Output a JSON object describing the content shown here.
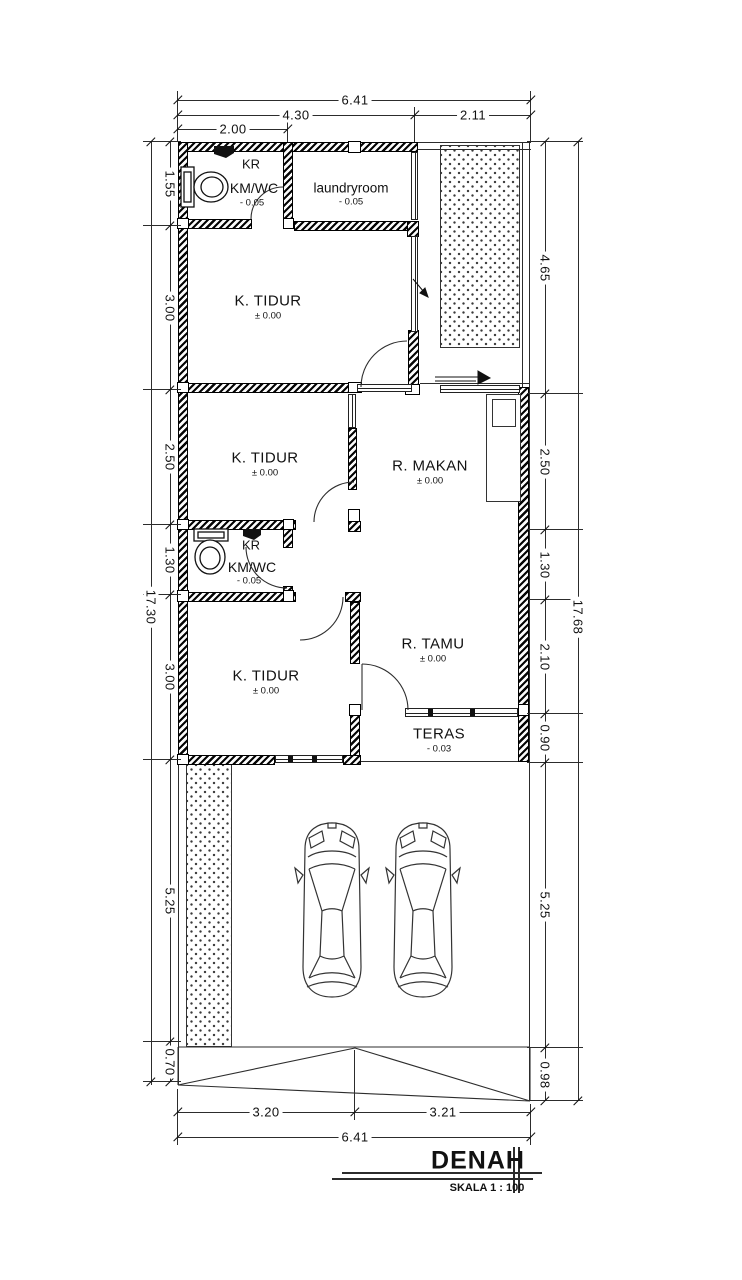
{
  "title": {
    "name": "DENAH",
    "scale": "SKALA 1 : 100"
  },
  "rooms": {
    "bathroom_top": {
      "corner_label": "KR",
      "label": "KM/WC",
      "level": "- 0.05"
    },
    "laundry": {
      "label": "laundryroom",
      "level": "- 0.05"
    },
    "bedroom_top": {
      "label": "K. TIDUR",
      "level": "± 0.00"
    },
    "bedroom_mid": {
      "label": "K. TIDUR",
      "level": "± 0.00"
    },
    "bathroom_mid": {
      "corner_label": "KR",
      "label": "KM/WC",
      "level": "- 0.05"
    },
    "bedroom_bottom": {
      "label": "K. TIDUR",
      "level": "± 0.00"
    },
    "dining": {
      "label": "R. MAKAN",
      "level": "± 0.00"
    },
    "living": {
      "label": "R. TAMU",
      "level": "± 0.00"
    },
    "terrace": {
      "label": "TERAS",
      "level": "- 0.03"
    }
  },
  "dimensions": {
    "top": [
      "6.41",
      "4.30",
      "2.11",
      "2.00"
    ],
    "left": [
      "1.55",
      "3.00",
      "2.50",
      "1.30",
      "3.00",
      "5.25",
      "0.70"
    ],
    "left_total": "17.30",
    "right": [
      "4.65",
      "2.50",
      "1.30",
      "2.10",
      "0.90",
      "5.25",
      "0.98"
    ],
    "right_total": "17.68",
    "bottom": [
      "3.20",
      "3.21",
      "6.41"
    ]
  }
}
